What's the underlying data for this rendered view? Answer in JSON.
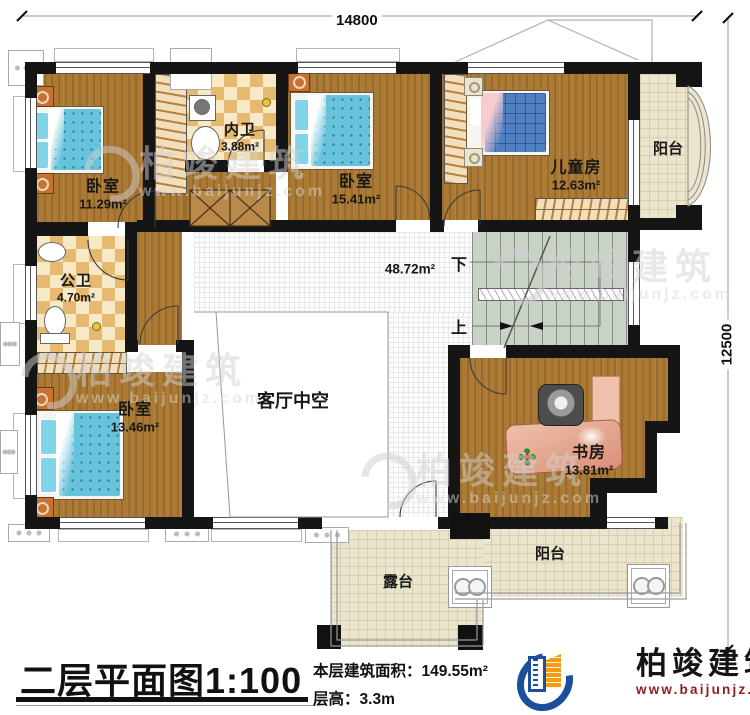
{
  "dimensions": {
    "width_mm": "14800",
    "height_mm": "12500"
  },
  "plan": {
    "hall_area": "48.72m²",
    "stairs_down": "下",
    "stairs_up": "上",
    "rooms": {
      "bedroom_top_left": {
        "name": "卧室",
        "area": "11.29m²"
      },
      "inner_bathroom": {
        "name": "内卫",
        "area": "3.88m²"
      },
      "bedroom_top_middle": {
        "name": "卧室",
        "area": "15.41m²"
      },
      "children_room": {
        "name": "儿童房",
        "area": "12.63m²"
      },
      "balcony_right": {
        "name": "阳台"
      },
      "public_bathroom": {
        "name": "公卫",
        "area": "4.70m²"
      },
      "bedroom_bottom_left": {
        "name": "卧室",
        "area": "13.46m²"
      },
      "living_room_void": {
        "name": "客厅中空"
      },
      "study": {
        "name": "书房",
        "area": "13.81m²"
      },
      "balcony_bottom": {
        "name": "阳台"
      },
      "terrace": {
        "name": "露台"
      }
    }
  },
  "footer": {
    "title": "二层平面图",
    "scale": "1:100",
    "floor_area_label": "本层建筑面积：",
    "floor_area_value": "149.55m²",
    "floor_height_label": "层高：",
    "floor_height_value": "3.3m",
    "logo": {
      "brand": "柏竣建筑",
      "url": "www.baijunjz.com"
    }
  },
  "watermark": {
    "brand": "柏竣建筑",
    "url": "www.baijunjz.com"
  },
  "colors": {
    "wall": "#151515",
    "wood": "#ab7a34",
    "tile": "#e5b96f",
    "stair_floor": "#c8d3c6",
    "balcony_floor": "#ebe5cd",
    "bed_blue": "#67c3dc",
    "kids_bed_blue": "#4f80c2",
    "logo_blue": "#1b4f9c",
    "logo_orange": "#f39c12",
    "logo_url_red": "#8e1d1d"
  }
}
